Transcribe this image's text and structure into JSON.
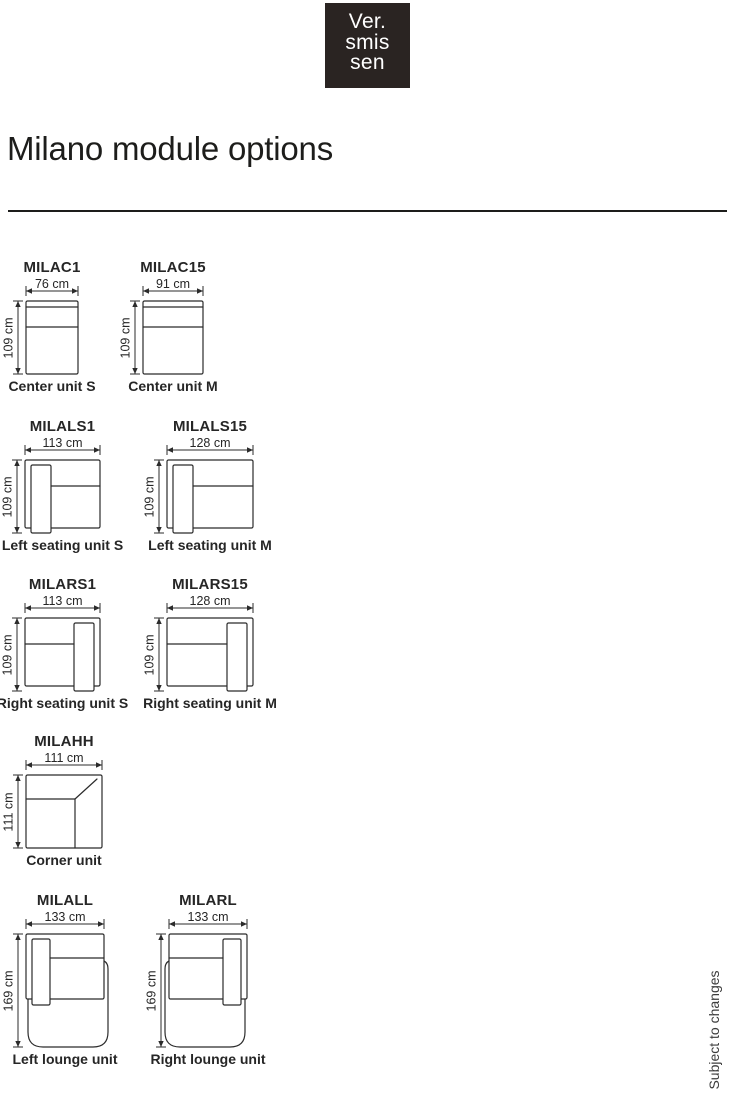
{
  "title": "Milano module options",
  "footnote": "Subject to changes",
  "logo": {
    "lines": [
      "Ver.",
      "smis",
      "sen"
    ],
    "bg": "#2a2422",
    "fg": "#ffffff"
  },
  "colors": {
    "ink": "#2b2b2b",
    "rule": "#1d1d1b"
  },
  "modules": [
    {
      "code": "MILAC1",
      "width_label": "76 cm",
      "height_label": "109 cm",
      "caption": "Center unit S",
      "type": "center",
      "geom": {
        "x": 26,
        "y": 301,
        "w": 52,
        "h": 73,
        "total_h": 73
      }
    },
    {
      "code": "MILAC15",
      "width_label": "91 cm",
      "height_label": "109 cm",
      "caption": "Center unit M",
      "type": "center",
      "geom": {
        "x": 143,
        "y": 301,
        "w": 60,
        "h": 73,
        "total_h": 73
      }
    },
    {
      "code": "MILALS1",
      "width_label": "113 cm",
      "height_label": "109 cm",
      "caption": "Left seating unit S",
      "type": "seat-left",
      "geom": {
        "x": 25,
        "y": 460,
        "w": 75,
        "h": 68,
        "total_h": 73
      }
    },
    {
      "code": "MILALS15",
      "width_label": "128 cm",
      "height_label": "109 cm",
      "caption": "Left seating unit M",
      "type": "seat-left",
      "geom": {
        "x": 167,
        "y": 460,
        "w": 86,
        "h": 68,
        "total_h": 73
      }
    },
    {
      "code": "MILARS1",
      "width_label": "113 cm",
      "height_label": "109 cm",
      "caption": "Right seating unit S",
      "type": "seat-right",
      "geom": {
        "x": 25,
        "y": 618,
        "w": 75,
        "h": 68,
        "total_h": 73
      }
    },
    {
      "code": "MILARS15",
      "width_label": "128 cm",
      "height_label": "109 cm",
      "caption": "Right seating unit M",
      "type": "seat-right",
      "geom": {
        "x": 167,
        "y": 618,
        "w": 86,
        "h": 68,
        "total_h": 73
      }
    },
    {
      "code": "MILAHH",
      "width_label": "111 cm",
      "height_label": "111 cm",
      "caption": "Corner unit",
      "type": "corner",
      "geom": {
        "x": 26,
        "y": 775,
        "w": 76,
        "h": 73,
        "total_h": 73
      }
    },
    {
      "code": "MILALL",
      "width_label": "133 cm",
      "height_label": "169 cm",
      "caption": "Left lounge unit",
      "type": "lounge-left",
      "geom": {
        "x": 26,
        "y": 934,
        "w": 78,
        "h": 65,
        "total_h": 113
      }
    },
    {
      "code": "MILARL",
      "width_label": "133 cm",
      "height_label": "169 cm",
      "caption": "Right lounge unit",
      "type": "lounge-right",
      "geom": {
        "x": 169,
        "y": 934,
        "w": 78,
        "h": 65,
        "total_h": 113
      }
    }
  ]
}
